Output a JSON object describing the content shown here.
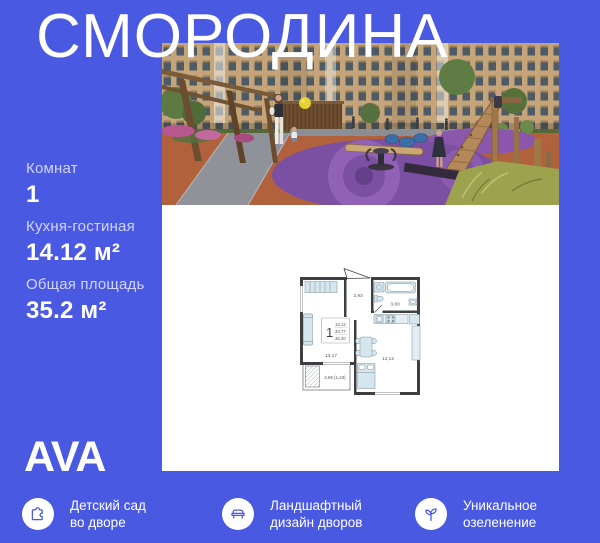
{
  "theme": {
    "background": "#4a59e2",
    "text_on_blue": "#ffffff",
    "icon_blue": "#4a59e2"
  },
  "title": "СМОРОДИНА",
  "specs": [
    {
      "label": "Комнат",
      "value": "1"
    },
    {
      "label": "Кухня-гостиная",
      "value": "14.12 м²"
    },
    {
      "label": "Общая площадь",
      "value": "35.2 м²"
    }
  ],
  "logo": "AVA",
  "photo": {
    "description": "courtyard-playground-render"
  },
  "floorplan": {
    "unit_rooms": "1",
    "area_stack": [
      "13,12",
      "33,77",
      "35,20"
    ],
    "rooms": {
      "hallway": "2,93",
      "bathroom": "3,60",
      "living_room": "13,17",
      "kitchen_living": "14,12",
      "balcony": "2,86 (1,43)"
    }
  },
  "features": [
    {
      "icon": "puzzle-icon",
      "lines": [
        "Детский сад",
        "во дворе"
      ]
    },
    {
      "icon": "bench-icon",
      "lines": [
        "Ландшафтный",
        "дизайн дворов"
      ]
    },
    {
      "icon": "sprout-icon",
      "lines": [
        "Уникальное",
        "озеленение"
      ]
    }
  ]
}
